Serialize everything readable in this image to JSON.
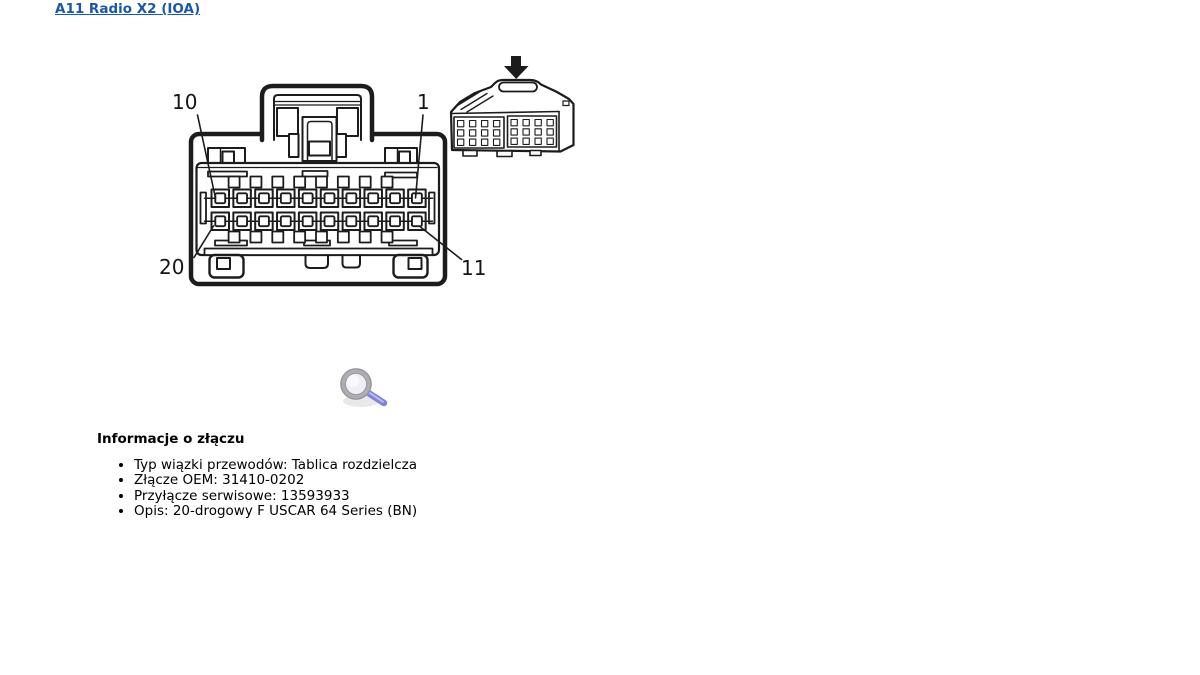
{
  "header": {
    "title": "A11 Radio X2 (IOA)"
  },
  "connector_view": {
    "rows": 2,
    "pins_per_row": 10,
    "pin_count": 20,
    "labels": [
      {
        "position": "top-left",
        "text": "10"
      },
      {
        "position": "top-right",
        "text": "1"
      },
      {
        "position": "bottom-left",
        "text": "20"
      },
      {
        "position": "bottom-right",
        "text": "11"
      }
    ],
    "icons": {
      "insertion_arrow": "down-arrow-icon",
      "zoom": "magnifier-icon"
    }
  },
  "info": {
    "heading": "Informacje o złączu",
    "items": [
      "Typ wiązki przewodów: Tablica rozdzielcza",
      "Złącze OEM: 31410-0202",
      "Przyłącze serwisowe: 13593933",
      "Opis: 20-drogowy F USCAR 64 Series (BN)"
    ]
  },
  "colors": {
    "link": "#1a57a8",
    "ink": "#1c1c1c",
    "magnifier_ring": "#adadb3",
    "magnifier_handle": "#7f82d8"
  }
}
